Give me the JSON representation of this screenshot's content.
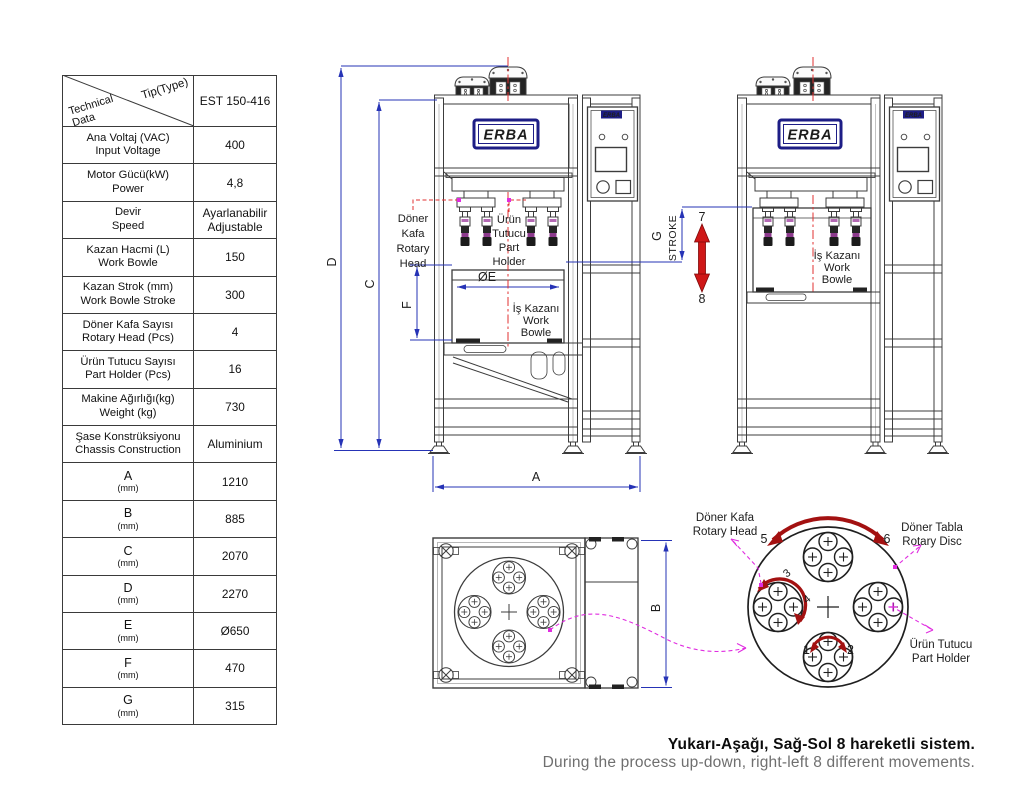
{
  "brand": {
    "logo": "ERBA"
  },
  "table": {
    "header": {
      "corner_top": "Tip(Type)",
      "corner_bottom_line1": "Technical",
      "corner_bottom_line2": "Data",
      "model": "EST 150-416"
    },
    "rows": [
      {
        "l1": "Ana Voltaj (VAC)",
        "l2": "Input Voltage",
        "v1": "400"
      },
      {
        "l1": "Motor Gücü(kW)",
        "l2": "Power",
        "v1": "4,8"
      },
      {
        "l1": "Devir",
        "l2": "Speed",
        "v1": "Ayarlanabilir",
        "v2": "Adjustable"
      },
      {
        "l1": "Kazan Hacmi (L)",
        "l2": "Work Bowle",
        "v1": "150"
      },
      {
        "l1": "Kazan Strok (mm)",
        "l2": "Work Bowle Stroke",
        "v1": "300"
      },
      {
        "l1": "Döner Kafa Sayısı",
        "l2": "Rotary Head (Pcs)",
        "v1": "4"
      },
      {
        "l1": "Ürün Tutucu Sayısı",
        "l2": "Part Holder (Pcs)",
        "v1": "16"
      },
      {
        "l1": "Makine Ağırlığı(kg)",
        "l2": "Weight (kg)",
        "v1": "730"
      },
      {
        "l1": "Şase Konstrüksiyonu",
        "l2": "Chassis Construction",
        "v1": "Aluminium"
      },
      {
        "l1": "A",
        "l2": "(mm)",
        "v1": "1210"
      },
      {
        "l1": "B",
        "l2": "(mm)",
        "v1": "885"
      },
      {
        "l1": "C",
        "l2": "(mm)",
        "v1": "2070"
      },
      {
        "l1": "D",
        "l2": "(mm)",
        "v1": "2270"
      },
      {
        "l1": "E",
        "l2": "(mm)",
        "v1": "Ø650"
      },
      {
        "l1": "F",
        "l2": "(mm)",
        "v1": "470"
      },
      {
        "l1": "G",
        "l2": "(mm)",
        "v1": "315"
      }
    ]
  },
  "drawing": {
    "dims": {
      "a": "A",
      "b": "B",
      "c": "C",
      "d": "D",
      "f": "F",
      "g": "G",
      "stroke": "STROKE",
      "oe": "ØE"
    },
    "motion": {
      "m1": "1",
      "m2": "2",
      "m3": "3",
      "m4": "4",
      "m5": "5",
      "m6": "6",
      "up": "7",
      "down": "8"
    },
    "labels": {
      "rotary_head": [
        "Döner",
        "Kafa",
        "Rotary",
        "Head"
      ],
      "part_holder": [
        "Ürün",
        "Tutucu",
        "Part",
        "Holder"
      ],
      "work_bowl": [
        "İş Kazanı",
        "Work",
        "Bowle"
      ],
      "rotary_head2": [
        "Döner Kafa",
        "Rotary Head"
      ],
      "rotary_disc2": [
        "Döner Tabla",
        "Rotary Disc"
      ],
      "part_holder2": [
        "Ürün Tutucu",
        "Part Holder"
      ]
    }
  },
  "caption": {
    "line1": "Yukarı-Aşağı, Sağ-Sol 8 hareketli sistem.",
    "line2": "During the process up-down, right-left 8 different movements."
  },
  "colors": {
    "dimension_blue": "#2633b6",
    "centerline_red": "#e23030",
    "leader_magenta": "#e02ce0",
    "rotation_dark_red": "#a31111",
    "logo_navy": "#1d1d86"
  }
}
